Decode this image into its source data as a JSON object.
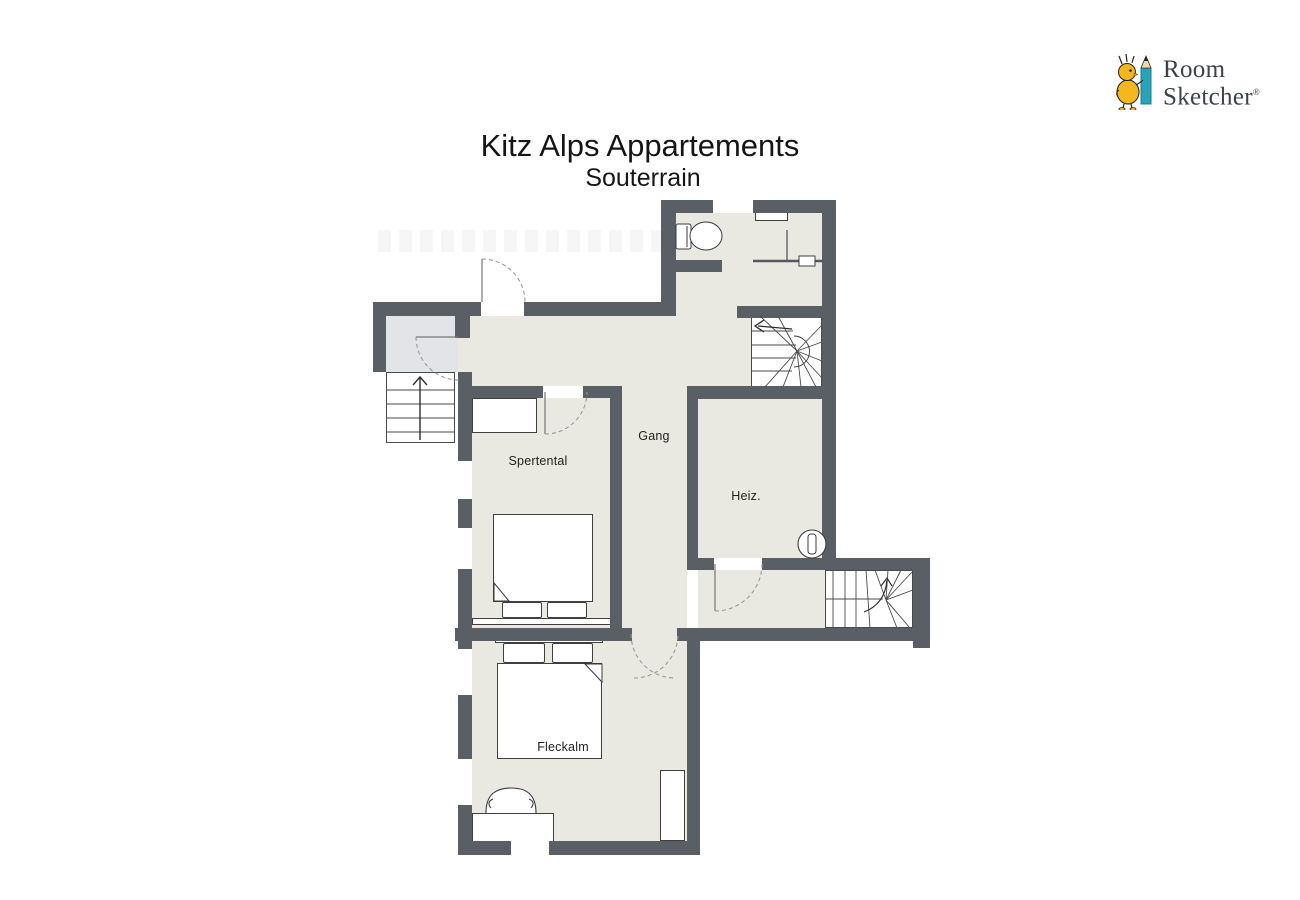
{
  "title": "Kitz Alps Appartements",
  "subtitle": "Souterrain",
  "brand": {
    "line1": "Room",
    "line2": "Sketcher",
    "registered": "®"
  },
  "rooms": {
    "corridor": "Gang",
    "bedroom_upper": "Spertental",
    "heating": "Heiz.",
    "bedroom_lower": "Fleckalm"
  },
  "colors": {
    "wall": "#5a5f66",
    "floor": "#e9e9e1",
    "entry_floor": "#e3e4e7",
    "logo_text": "#3c4249",
    "mascot_yellow": "#f4b71c",
    "pencil_teal": "#2aa3b8"
  }
}
